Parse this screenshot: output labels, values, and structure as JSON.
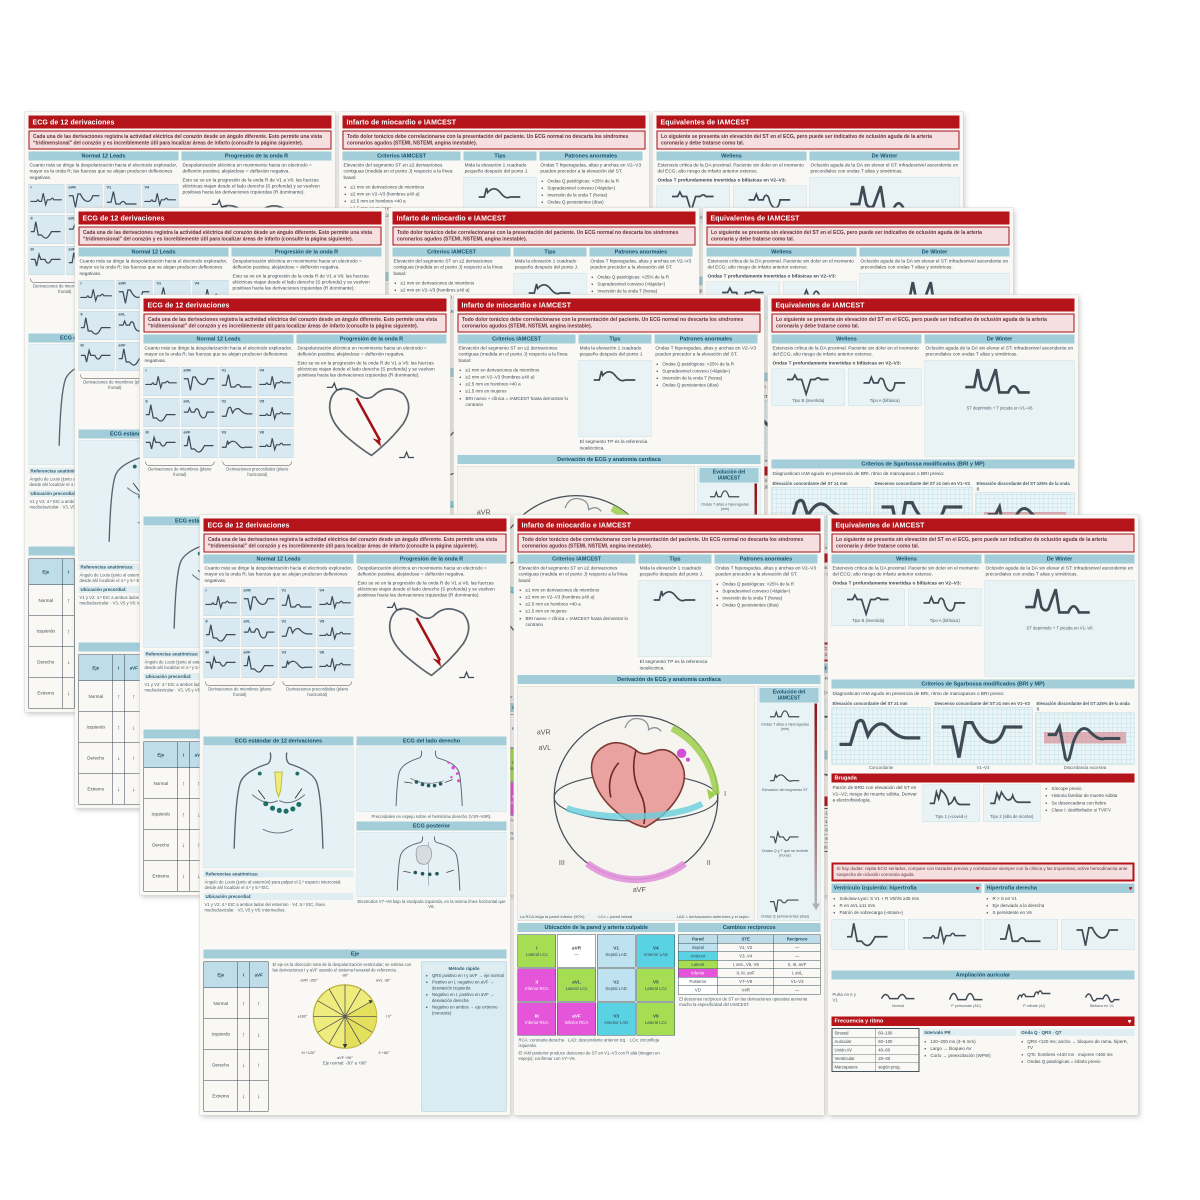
{
  "page": {
    "background": "#ffffff"
  },
  "colors": {
    "header_red": "#b5141b",
    "intro_pink": "#f5dfe0",
    "section_teal": "#a3ced9",
    "teal_text": "#14506e",
    "panel_blue": "#e6f1f5",
    "lateral_green": "#a5de52",
    "inferior_magenta": "#e455d9",
    "anterior_cyan": "#59d3e4",
    "septal_blue": "#bfe2f0",
    "pie_yellow": "#efec7e",
    "heart_pink": "#e9a2a0",
    "arrow_red": "#8f1014"
  },
  "layout": {
    "card_order": [
      "c1",
      "c2",
      "c3"
    ],
    "pitch": 314,
    "layers": [
      {
        "x": 25,
        "y": 112
      },
      {
        "x": 75,
        "y": 208
      },
      {
        "x": 140,
        "y": 295
      },
      {
        "x": 200,
        "y": 515
      }
    ]
  },
  "cards": {
    "c1": {
      "title": "ECG de 12 derivaciones",
      "intro": "Cada una de las derivaciones registra la actividad eléctrica del corazón desde un ángulo diferente. Esto permite una vista “tridimensional” del corazón y es increíblemente útil para localizar áreas de infarto (consulte la página siguiente).",
      "col1_header": "Normal 12 Leads",
      "col1_note": "Cuanto más se dirige la despolarización hacia el electrodo explorador, mayor es la onda R; las fuerzas que se alejan producen deflexiones negativas.",
      "leads": [
        "I",
        "aVR",
        "V1",
        "V4",
        "II",
        "aVL",
        "V2",
        "V5",
        "III",
        "aVF",
        "V3",
        "V6"
      ],
      "brace1": "Derivaciones de miembros (plano frontal)",
      "brace2": "Derivaciones precordiales (plano horizontal)",
      "col2_header": "Progresión de la onda R",
      "col2_text1": "Despolarización eléctrica en movimiento hacia un electrodo = deflexión positiva; alejándose = deflexión negativa.",
      "col2_text2": "Esto se ve en la progresión de la onda R de V1 a V6: las fuerzas eléctricas viajan desde el lado derecho (S profunda) y se vuelven positivas hacia las derivaciones izquierdas (R dominante).",
      "torso1_header": "ECG estándar de 12 derivaciones",
      "torso1_cap1": "Referencias anatómicas:",
      "torso1_cap2": "Ángulo de Louis (junto al esternón) para palpar el 2.º espacio intercostal; desde ahí localizar el 4.º y 5.º EIC.",
      "torso1_cap3": "Ubicación precordial:",
      "torso1_cap4": "V1 y V2: 4.º EIC a ambos lados del esternón · V4: 5.º EIC, línea medioclavicular · V3, V5 y V6: intermedios.",
      "torso2_header": "ECG del lado derecho",
      "torso2_cap": "Precordiales en espejo sobre el hemitórax derecho (V1R–V6R).",
      "torso3_header": "ECG posterior",
      "torso3_cap": "Electrodos V7–V9 bajo la escápula izquierda, en la misma línea horizontal que V6.",
      "axis_band": "Eje",
      "axis_intro": "El eje es la dirección neta de la despolarización ventricular; se estima con las derivaciones I y aVF usando el sistema hexaxial de referencia.",
      "axis_table": {
        "header": [
          "Eje",
          "I",
          "aVF"
        ],
        "rows": [
          [
            "Normal",
            "↑",
            "↑"
          ],
          [
            "Izquierdo",
            "↑",
            "↓"
          ],
          [
            "Derecho",
            "↓",
            "↑"
          ],
          [
            "Extremo",
            "↓",
            "↓"
          ]
        ]
      },
      "pie_labels": [
        "-90°",
        "aVR -150°",
        "aVL -30°",
        "±180°",
        "I 0°",
        "III +120°",
        "II +60°",
        "aVF +90°"
      ],
      "pie_cap": "Eje normal: -30° a +90°",
      "infobox_title": "Método rápido",
      "infobox_bullets": [
        "QRS positivo en I y aVF → eje normal",
        "Positivo en I, negativo en aVF → desviación izquierda",
        "Negativo en I, positivo en aVF → desviación derecha",
        "Negativo en ambos → eje extremo (noroeste)"
      ]
    },
    "c2": {
      "title": "Infarto de miocardio e IAMCEST",
      "intro": "Todo dolor torácico debe correlacionarse con la presentación del paciente. Un ECG normal no descarta los síndromes coronarios agudos (STEMI, NSTEMI, angina inestable).",
      "col1_header": "Criterios IAMCEST",
      "col1_text": "Elevación del segmento ST en ≥2 derivaciones contiguas (medida en el punto J) respecto a la línea basal:",
      "col1_bullets": [
        "≥1 mm en derivaciones de miembros",
        "≥2 mm en V2–V3 (hombres ≥40 a)",
        "≥2.5 mm en hombres <40 a",
        "≥1.5 mm en mujeres",
        "BRI nuevo + clínica = IAMCEST hasta demostrar lo contrario"
      ],
      "col2_header": "Tips",
      "col2_text1": "Mida la elevación 1 cuadrado pequeño después del punto J.",
      "col2_text2": "El segmento TP es la referencia isoeléctrica.",
      "col3_header": "Patrones anormales",
      "col3_text": "Ondas T hiperagudas, altas y anchas en V2–V3 pueden preceder a la elevación del ST.",
      "col3_bullets": [
        "Ondas Q patológicas: >25% de la R",
        "Supradesnivel convexo («lápida»)",
        "Inversión de la onda T (horas)",
        "Ondas Q persistentes (días)"
      ],
      "sphere_header": "Derivación de ECG y anatomía cardíaca",
      "sphere_left_cap": "La RCA irriga la pared inferior (90%)",
      "sphere_mid_cap": "LCx = pared lateral",
      "sphere_right_cap": "LAD = derivaciones anteriores y el septo",
      "evo_header": "Evolución del IAMCEST",
      "evo_items": [
        "Ondas T altas e hiperagudas (min)",
        "Elevación del segmento ST",
        "Ondas Q y T que se invierte (horas)",
        "Ondas Q permanentes (días)"
      ],
      "loc_header": "Ubicación de la pared y arteria culpable",
      "loc_cells": [
        {
          "lead": "I",
          "wall": "Lateral LCx"
        },
        {
          "lead": "aVR",
          "wall": "—"
        },
        {
          "lead": "V1",
          "wall": "Septal LAD"
        },
        {
          "lead": "V4",
          "wall": "Anterior LAD"
        },
        {
          "lead": "II",
          "wall": "Inferior RCA"
        },
        {
          "lead": "aVL",
          "wall": "Lateral LCx"
        },
        {
          "lead": "V2",
          "wall": "Septal LAD"
        },
        {
          "lead": "V5",
          "wall": "Lateral LCx"
        },
        {
          "lead": "III",
          "wall": "Inferior RCA"
        },
        {
          "lead": "aVF",
          "wall": "Inferior RCA"
        },
        {
          "lead": "V3",
          "wall": "Anterior LAD"
        },
        {
          "lead": "V6",
          "wall": "Lateral LCx"
        }
      ],
      "loc_foot1": "RCA: coronaria derecha · LAD: descendente anterior izq. · LCx: circunfleja izquierda.",
      "loc_foot2": "El IAM posterior produce descenso de ST en V1–V3 con R alta (imagen en espejo); confirmar con V7–V9.",
      "rec_header": "Cambios recíprocos",
      "rec_cols": [
        "Pared",
        "STE",
        "Recíproco"
      ],
      "rec_rows": [
        [
          "Septal",
          "V1, V2",
          "—"
        ],
        [
          "Anterior",
          "V3, V4",
          "—"
        ],
        [
          "Lateral",
          "I, aVL, V5, V6",
          "II, III, aVF"
        ],
        [
          "Inferior",
          "II, III, aVF",
          "I, aVL"
        ],
        [
          "Posterior",
          "V7–V9",
          "V1–V3"
        ],
        [
          "VD",
          "V4R",
          "—"
        ]
      ],
      "rec_foot": "El descenso recíproco de ST en las derivaciones opuestas aumenta mucho la especificidad del IAMCEST."
    },
    "c3": {
      "title": "Equivalentes de IAMCEST",
      "intro": "Lo siguiente se presenta sin elevación del ST en el ECG, pero puede ser indicativo de oclusión aguda de la arteria coronaria y debe tratarse como tal.",
      "w_header": "Wellens",
      "w_text": "Estenosis crítica de la DA proximal. Paciente sin dolor en el momento del ECG; alto riesgo de infarto anterior extenso.",
      "w_sub": "Ondas T profundamente invertidas o bifásicas en V2–V3:",
      "w_cap1": "Tipo B (invertida)",
      "w_cap2": "Tipo A (bifásica)",
      "d_header": "De Winter",
      "d_text": "Oclusión aguda de la DA sin elevar el ST: infradesnivel ascendente en precordiales con ondas T altas y simétricas.",
      "d_cap": "ST deprimido + T picuda en V1–V6",
      "sg_header": "Criterios de Sgarbossa modificados (BRI y MP)",
      "sg_note": "Diagnostican IAM agudo en presencia de BRI, ritmo de marcapasos o BRI previo:",
      "sg_items": [
        "Elevación concordante del ST ≥1 mm",
        "Descenso concordante del ST ≥1 mm en V1–V3",
        "Elevación discordante del ST ≥25% de la onda S"
      ],
      "sg_caps": [
        "Concordante",
        "V1–V3",
        "Discordancia excesiva"
      ],
      "br_band": "Brugada",
      "br_text": "Patrón de BRD con elevación del ST en V1–V2; riesgo de muerte súbita. Derivar a electrofisiología.",
      "br_cap1": "Tipo 1 («coved»)",
      "br_cap2": "Tipo 2 (silla de montar)",
      "br_bullets": [
        "Síncope previo",
        "Historia familiar de muerte súbita",
        "Se desencadena con fiebre",
        "Clase I: desfibrilador si TV/FV"
      ],
      "alert_text": "Si hay dudas: repita ECG seriados, compare con trazados previos y correlacione siempre con la clínica y las troponinas; active hemodinamia ante sospecha de oclusión coronaria aguda.",
      "lvh_header": "Ventrículo izquierdo: hipertrofia",
      "lvh_bullets": [
        "Sokolow-Lyon: S V1 + R V5/V6 ≥35 mm",
        "R en aVL ≥11 mm",
        "Patrón de sobrecarga («strain»)"
      ],
      "rvh_header": "Hipertrofia derecha",
      "rvh_bullets": [
        "R > S en V1",
        "Eje desviado a la derecha",
        "S persistente en V6"
      ],
      "at_band": "Ampliación auricular",
      "at_label": "Pulso en II y V1",
      "at_items": [
        "Normal",
        "P pulmonale (AD)",
        "P mitrale (AI)",
        "Bifásica en V1"
      ],
      "fr_band": "Frecuencia y ritmo",
      "fr_rows": [
        [
          "Sinusal",
          "60–100"
        ],
        [
          "Auricular",
          "60–100"
        ],
        [
          "Unión AV",
          "40–60"
        ],
        [
          "Ventricular",
          "20–40"
        ],
        [
          "Marcapasos",
          "según prog."
        ]
      ],
      "pr_header": "Intervalo PR",
      "pr_bullets": [
        "120–200 ms (3–5 mm)",
        "Largo → bloqueo AV",
        "Corto → preexcitación (WPW)"
      ],
      "qt_header": "Onda Q · QRS · QT",
      "qt_bullets": [
        "QRS <120 ms; ancho → bloqueo de rama, hiperK, TV",
        "QTc: hombres <440 ms · mujeres <460 ms",
        "Ondas Q patológicas = infarto previo"
      ]
    }
  }
}
